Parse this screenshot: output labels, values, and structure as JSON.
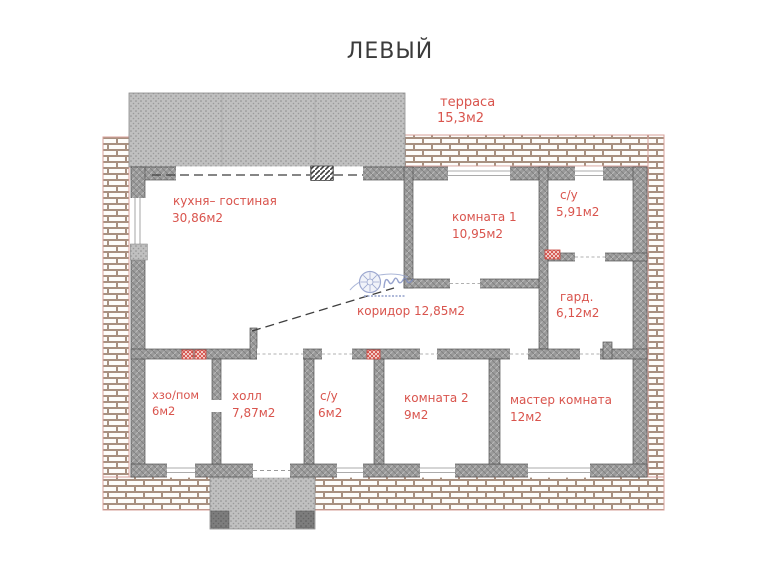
{
  "title": "ЛЕВЫЙ",
  "rooms": {
    "terrace": {
      "name": "терраса",
      "area": "15,3м2"
    },
    "kitchen_living": {
      "name": "кухня– гостиная",
      "area": "30,86м2"
    },
    "room1": {
      "name": "комната 1",
      "area": "10,95м2"
    },
    "bathroom1": {
      "name": "с/у",
      "area": "5,91м2"
    },
    "wardrobe": {
      "name": "гард.",
      "area": "6,12м2"
    },
    "corridor": {
      "name": "коридор",
      "area": "12,85м2"
    },
    "utility": {
      "name": "хзо/пом",
      "area": "6м2"
    },
    "hall": {
      "name": "холл",
      "area": "7,87м2"
    },
    "bathroom2": {
      "name": "с/у",
      "area": "6м2"
    },
    "room2": {
      "name": "комната 2",
      "area": "9м2"
    },
    "master": {
      "name": "мастер комната",
      "area": "12м2"
    }
  },
  "colors": {
    "label_red": "#d9544d",
    "title_gray": "#3b3b3b",
    "wall_gray": "#999999",
    "brick_mortar": "#a89080",
    "logo_blue": "#8593c5"
  }
}
